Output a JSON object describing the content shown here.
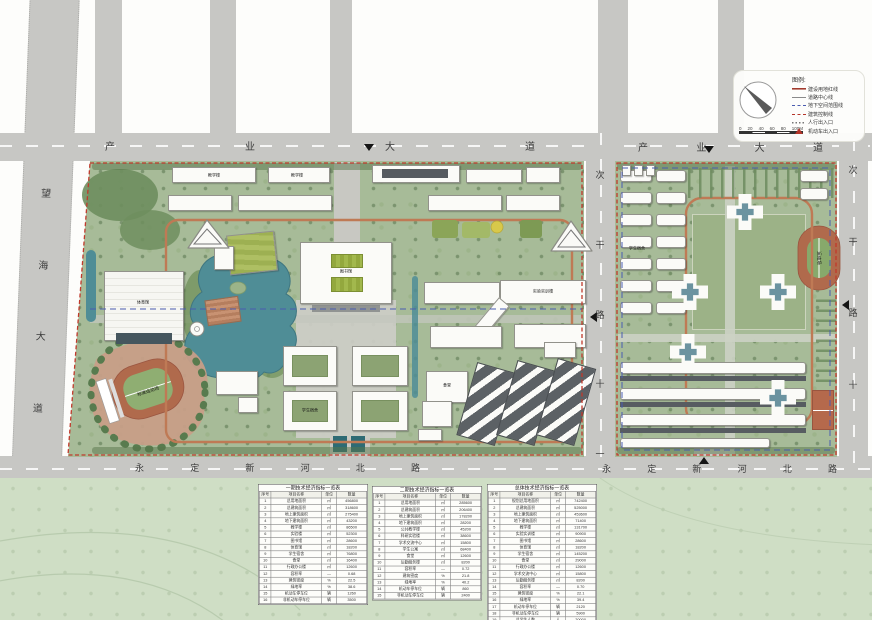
{
  "map": {
    "roads": {
      "top_left": "产业大道",
      "top_right": "产业大道",
      "left": "望海大道",
      "middle": "次干路十一",
      "right": "次干路十",
      "bottom_left": "永定新河北路",
      "bottom_right": "永定新河北路"
    }
  },
  "labels": {
    "library": "图书馆",
    "gym": "体育馆",
    "stadium": "标准运动场",
    "canteen": "食堂",
    "lab": "实验实训楼",
    "teach_a": "教学楼",
    "teach_b": "教学楼",
    "dorm_west": "学生宿舍",
    "dorm_east": "学生宿舍",
    "track_east": "运动场"
  },
  "legend": {
    "title": "图例:",
    "items": [
      {
        "symbol": "solid-red",
        "label": "建设用地红线"
      },
      {
        "symbol": "solid-gray",
        "label": "道路中心线"
      },
      {
        "symbol": "dash-blue",
        "label": "地下空间范围线"
      },
      {
        "symbol": "dash-red",
        "label": "建筑控制线"
      },
      {
        "symbol": "dot-gray",
        "label": "人行出入口"
      },
      {
        "symbol": "tri-red",
        "label": "机动车出入口"
      }
    ],
    "scale_ticks": [
      "0",
      "20",
      "40",
      "60",
      "80",
      "100M"
    ]
  },
  "tables": [
    {
      "title": "一期技术经济指标一览表",
      "columns": [
        "序号",
        "项目名称",
        "单位",
        "数量"
      ],
      "rows": [
        [
          "1",
          "总用地面积",
          "㎡",
          "456800"
        ],
        [
          "2",
          "总建筑面积",
          "㎡",
          "318600"
        ],
        [
          "3",
          "地上建筑面积",
          "㎡",
          "275400"
        ],
        [
          "4",
          "地下建筑面积",
          "㎡",
          "43200"
        ],
        [
          "5",
          "教学楼",
          "㎡",
          "86500"
        ],
        [
          "6",
          "实验楼",
          "㎡",
          "52300"
        ],
        [
          "7",
          "图书馆",
          "㎡",
          "28600"
        ],
        [
          "8",
          "体育馆",
          "㎡",
          "18200"
        ],
        [
          "9",
          "学生宿舍",
          "㎡",
          "76800"
        ],
        [
          "10",
          "食堂",
          "㎡",
          "16400"
        ],
        [
          "11",
          "行政办公楼",
          "㎡",
          "12600"
        ],
        [
          "12",
          "容积率",
          "—",
          "0.68"
        ],
        [
          "13",
          "建筑密度",
          "%",
          "22.5"
        ],
        [
          "14",
          "绿地率",
          "%",
          "38.6"
        ],
        [
          "15",
          "机动车停车位",
          "辆",
          "1260"
        ],
        [
          "16",
          "非机动车停车位",
          "辆",
          "3500"
        ]
      ]
    },
    {
      "title": "二期技术经济指标一览表",
      "columns": [
        "序号",
        "项目名称",
        "单位",
        "数量"
      ],
      "rows": [
        [
          "1",
          "总用地面积",
          "㎡",
          "285600"
        ],
        [
          "2",
          "总建筑面积",
          "㎡",
          "206400"
        ],
        [
          "3",
          "地上建筑面积",
          "㎡",
          "178200"
        ],
        [
          "4",
          "地下建筑面积",
          "㎡",
          "28200"
        ],
        [
          "5",
          "公共教学楼",
          "㎡",
          "45200"
        ],
        [
          "6",
          "科研实验楼",
          "㎡",
          "38600"
        ],
        [
          "7",
          "学术交流中心",
          "㎡",
          "15800"
        ],
        [
          "8",
          "学生公寓",
          "㎡",
          "68400"
        ],
        [
          "9",
          "食堂",
          "㎡",
          "12600"
        ],
        [
          "10",
          "后勤服务楼",
          "㎡",
          "8200"
        ],
        [
          "11",
          "容积率",
          "—",
          "0.72"
        ],
        [
          "12",
          "建筑密度",
          "%",
          "21.8"
        ],
        [
          "13",
          "绿地率",
          "%",
          "40.2"
        ],
        [
          "14",
          "机动车停车位",
          "辆",
          "860"
        ],
        [
          "15",
          "非机动车停车位",
          "辆",
          "2400"
        ]
      ]
    },
    {
      "title": "总体技术经济指标一览表",
      "columns": [
        "序号",
        "项目名称",
        "单位",
        "数量"
      ],
      "rows": [
        [
          "1",
          "规划总用地面积",
          "㎡",
          "742400"
        ],
        [
          "2",
          "总建筑面积",
          "㎡",
          "525000"
        ],
        [
          "3",
          "地上建筑面积",
          "㎡",
          "453600"
        ],
        [
          "4",
          "地下建筑面积",
          "㎡",
          "71400"
        ],
        [
          "5",
          "教学楼",
          "㎡",
          "131700"
        ],
        [
          "6",
          "实验实训楼",
          "㎡",
          "90900"
        ],
        [
          "7",
          "图书馆",
          "㎡",
          "28600"
        ],
        [
          "8",
          "体育馆",
          "㎡",
          "18200"
        ],
        [
          "9",
          "学生宿舍",
          "㎡",
          "145200"
        ],
        [
          "10",
          "食堂",
          "㎡",
          "29000"
        ],
        [
          "11",
          "行政办公楼",
          "㎡",
          "12600"
        ],
        [
          "12",
          "学术交流中心",
          "㎡",
          "15800"
        ],
        [
          "13",
          "后勤服务楼",
          "㎡",
          "8200"
        ],
        [
          "14",
          "容积率",
          "—",
          "0.70"
        ],
        [
          "15",
          "建筑密度",
          "%",
          "22.1"
        ],
        [
          "16",
          "绿地率",
          "%",
          "39.4"
        ],
        [
          "17",
          "机动车停车位",
          "辆",
          "2120"
        ],
        [
          "18",
          "非机动车停车位",
          "辆",
          "5900"
        ],
        [
          "19",
          "总学生人数",
          "人",
          "20000"
        ]
      ]
    }
  ]
}
